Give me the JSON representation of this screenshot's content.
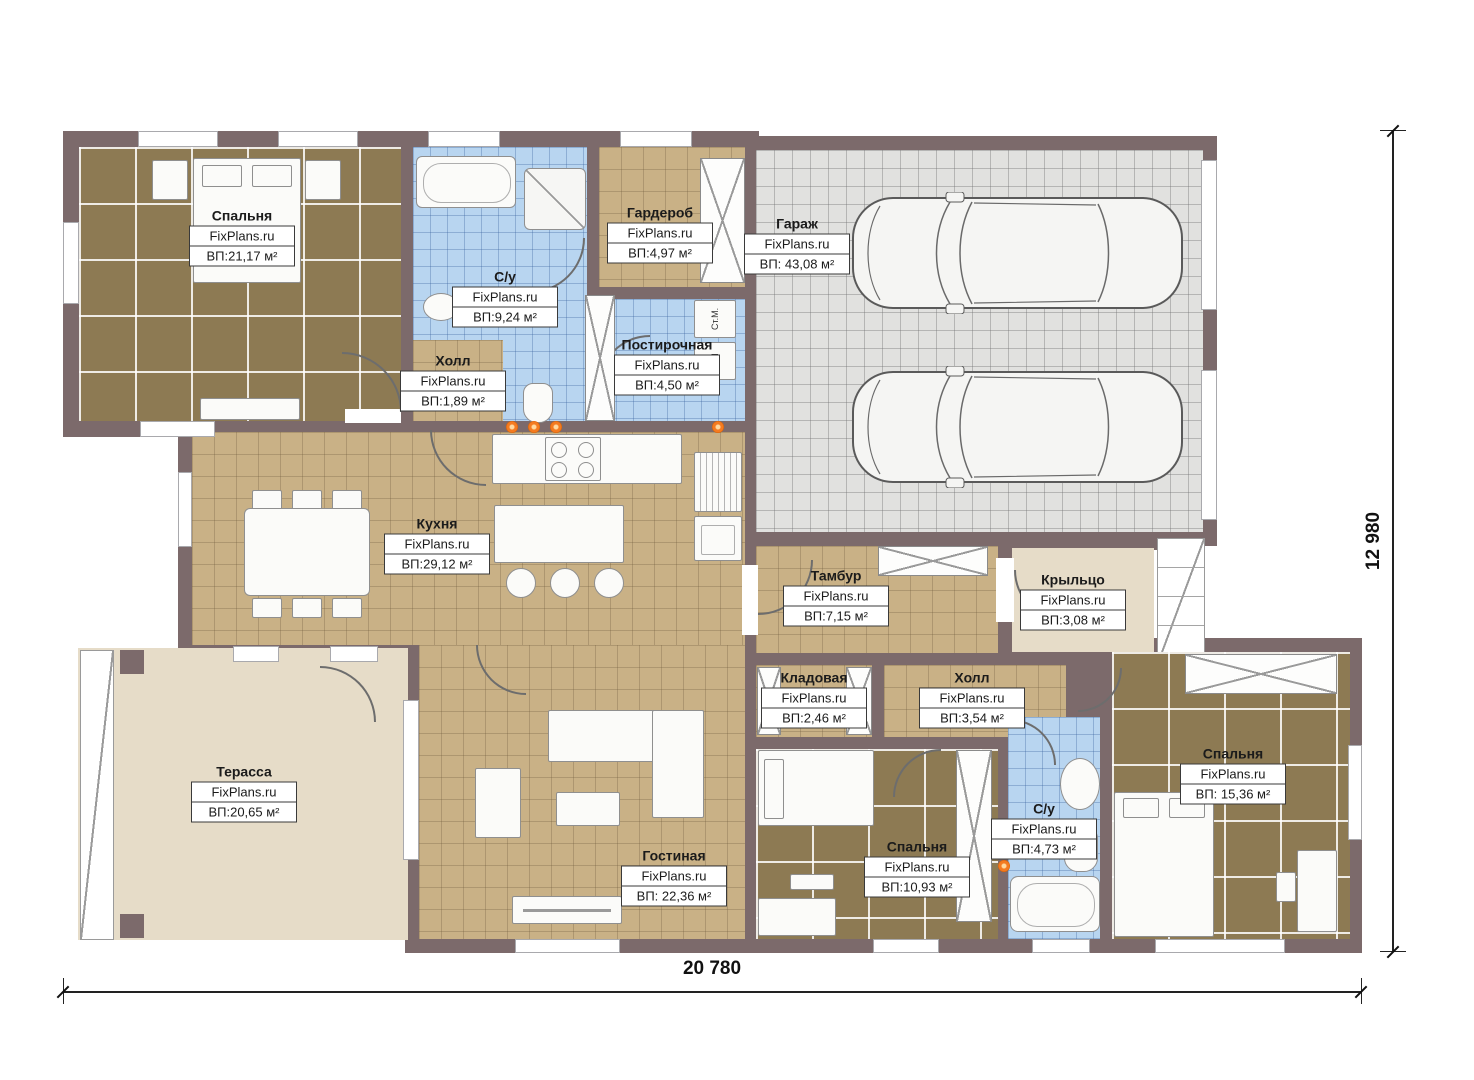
{
  "watermark": "FixPlans.ru",
  "dimensions": {
    "width_label": "20 780",
    "height_label": "12 980"
  },
  "rooms": {
    "bedroom1": {
      "name": "Спальня",
      "area": "ВП:21,17 м²"
    },
    "bathroom1": {
      "name": "С/у",
      "area": "ВП:9,24 м²"
    },
    "hall1": {
      "name": "Холл",
      "area": "ВП:1,89 м²"
    },
    "wardrobe": {
      "name": "Гардероб",
      "area": "ВП:4,97 м²"
    },
    "laundry": {
      "name": "Постирочная",
      "area": "ВП:4,50 м²"
    },
    "garage": {
      "name": "Гараж",
      "area": "ВП: 43,08 м²"
    },
    "kitchen": {
      "name": "Кухня",
      "area": "ВП:29,12 м²"
    },
    "tambour": {
      "name": "Тамбур",
      "area": "ВП:7,15 м²"
    },
    "porch": {
      "name": "Крыльцо",
      "area": "ВП:3,08 м²"
    },
    "pantry": {
      "name": "Кладовая",
      "area": "ВП:2,46 м²"
    },
    "hall2": {
      "name": "Холл",
      "area": "ВП:3,54 м²"
    },
    "bedroom2": {
      "name": "Спальня",
      "area": "ВП:10,93 м²"
    },
    "bathroom2": {
      "name": "С/у",
      "area": "ВП:4,73 м²"
    },
    "bedroom3": {
      "name": "Спальня",
      "area": "ВП: 15,36 м²"
    },
    "terrace": {
      "name": "Терасса",
      "area": "ВП:20,65 м²"
    },
    "living": {
      "name": "Гостиная",
      "area": "ВП: 22,36 м²"
    }
  },
  "appliances": {
    "washer": "Ст.М.",
    "dryer": "СШ"
  },
  "colors": {
    "wall": "#7c6a6b",
    "floor_brown": "#8d7a53",
    "floor_tan": "#c9b186",
    "floor_blue": "#b8d5f0",
    "floor_garage": "#e1e1df",
    "terrace": "#e6dcc8",
    "accent_dot": "#f47b20"
  }
}
